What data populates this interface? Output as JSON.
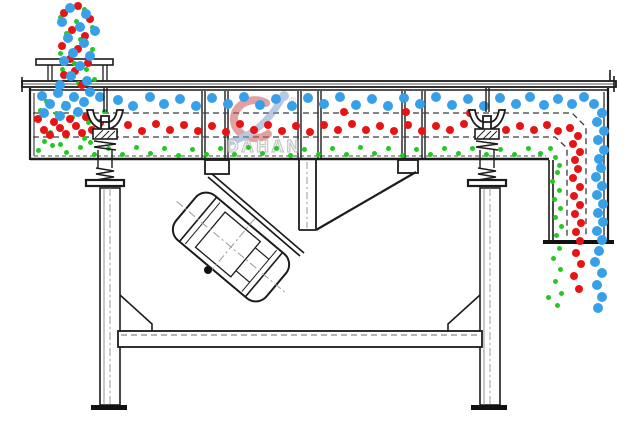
{
  "diagram": {
    "subject": "linear vibrating screen side-section schematic",
    "line_color": "#1c1c1c",
    "centerline_color": "#999999",
    "deck_dash_color": "#3c3c3c",
    "background": "#ffffff"
  },
  "watermark": {
    "text": "DAHAN",
    "reg_mark": "®",
    "letter_color": "#9a9a9a",
    "swoosh_blue": "#7d9cc8",
    "swoosh_red": "#cc5555"
  },
  "particles": {
    "blue": {
      "color": "#38a0e8",
      "diameter": 10,
      "dots": [
        [
          70,
          8
        ],
        [
          86,
          14
        ],
        [
          62,
          22
        ],
        [
          80,
          27
        ],
        [
          95,
          31
        ],
        [
          68,
          38
        ],
        [
          84,
          43
        ],
        [
          73,
          53
        ],
        [
          90,
          56
        ],
        [
          64,
          61
        ],
        [
          80,
          66
        ],
        [
          71,
          76
        ],
        [
          87,
          81
        ],
        [
          60,
          85
        ],
        [
          42,
          96
        ],
        [
          58,
          93
        ],
        [
          74,
          97
        ],
        [
          90,
          92
        ],
        [
          50,
          104
        ],
        [
          66,
          106
        ],
        [
          84,
          102
        ],
        [
          100,
          97
        ],
        [
          44,
          113
        ],
        [
          60,
          116
        ],
        [
          78,
          112
        ],
        [
          118,
          100
        ],
        [
          133,
          106
        ],
        [
          150,
          97
        ],
        [
          164,
          104
        ],
        [
          180,
          99
        ],
        [
          196,
          106
        ],
        [
          212,
          98
        ],
        [
          228,
          104
        ],
        [
          244,
          97
        ],
        [
          260,
          105
        ],
        [
          276,
          99
        ],
        [
          292,
          106
        ],
        [
          308,
          98
        ],
        [
          324,
          104
        ],
        [
          340,
          97
        ],
        [
          356,
          105
        ],
        [
          372,
          99
        ],
        [
          388,
          106
        ],
        [
          404,
          98
        ],
        [
          420,
          104
        ],
        [
          436,
          97
        ],
        [
          452,
          105
        ],
        [
          468,
          99
        ],
        [
          484,
          106
        ],
        [
          500,
          98
        ],
        [
          516,
          104
        ],
        [
          530,
          97
        ],
        [
          544,
          105
        ],
        [
          558,
          99
        ],
        [
          572,
          104
        ],
        [
          584,
          97
        ],
        [
          594,
          104
        ],
        [
          602,
          113
        ],
        [
          597,
          122
        ],
        [
          604,
          131
        ],
        [
          598,
          140
        ],
        [
          604,
          150
        ],
        [
          599,
          159
        ],
        [
          601,
          168
        ],
        [
          596,
          177
        ],
        [
          602,
          186
        ],
        [
          597,
          195
        ],
        [
          603,
          204
        ],
        [
          598,
          213
        ],
        [
          603,
          222
        ],
        [
          597,
          231
        ],
        [
          602,
          240
        ],
        [
          599,
          251
        ],
        [
          595,
          262
        ],
        [
          602,
          273
        ],
        [
          597,
          285
        ],
        [
          602,
          297
        ],
        [
          598,
          308
        ]
      ]
    },
    "red": {
      "color": "#e81414",
      "diameter": 8,
      "dots": [
        [
          78,
          6
        ],
        [
          64,
          13
        ],
        [
          90,
          19
        ],
        [
          72,
          30
        ],
        [
          85,
          36
        ],
        [
          62,
          46
        ],
        [
          78,
          49
        ],
        [
          70,
          59
        ],
        [
          88,
          63
        ],
        [
          75,
          71
        ],
        [
          64,
          75
        ],
        [
          82,
          85
        ],
        [
          38,
          119
        ],
        [
          54,
          122
        ],
        [
          70,
          119
        ],
        [
          86,
          117
        ],
        [
          100,
          123
        ],
        [
          44,
          130
        ],
        [
          60,
          128
        ],
        [
          76,
          126
        ],
        [
          92,
          130
        ],
        [
          50,
          135
        ],
        [
          66,
          134
        ],
        [
          82,
          133
        ],
        [
          114,
          132
        ],
        [
          128,
          125
        ],
        [
          142,
          131
        ],
        [
          156,
          124
        ],
        [
          170,
          130
        ],
        [
          184,
          125
        ],
        [
          198,
          131
        ],
        [
          212,
          126
        ],
        [
          226,
          132
        ],
        [
          240,
          124
        ],
        [
          254,
          130
        ],
        [
          268,
          125
        ],
        [
          282,
          131
        ],
        [
          296,
          126
        ],
        [
          310,
          132
        ],
        [
          324,
          125
        ],
        [
          338,
          130
        ],
        [
          352,
          124
        ],
        [
          366,
          130
        ],
        [
          380,
          126
        ],
        [
          394,
          131
        ],
        [
          408,
          125
        ],
        [
          422,
          131
        ],
        [
          436,
          126
        ],
        [
          450,
          130
        ],
        [
          464,
          124
        ],
        [
          506,
          130
        ],
        [
          520,
          126
        ],
        [
          534,
          130
        ],
        [
          547,
          125
        ],
        [
          558,
          131
        ],
        [
          344,
          112
        ],
        [
          406,
          112
        ],
        [
          470,
          113
        ],
        [
          570,
          128
        ],
        [
          578,
          136
        ],
        [
          573,
          144
        ],
        [
          580,
          152
        ],
        [
          575,
          160
        ],
        [
          578,
          169
        ],
        [
          573,
          178
        ],
        [
          580,
          187
        ],
        [
          574,
          196
        ],
        [
          580,
          205
        ],
        [
          575,
          214
        ],
        [
          581,
          223
        ],
        [
          576,
          232
        ],
        [
          580,
          241
        ],
        [
          576,
          253
        ],
        [
          581,
          264
        ],
        [
          574,
          276
        ],
        [
          579,
          289
        ]
      ]
    },
    "green": {
      "color": "#22c922",
      "diameter": 5,
      "dots": [
        [
          84,
          9
        ],
        [
          60,
          17
        ],
        [
          76,
          21
        ],
        [
          92,
          27
        ],
        [
          66,
          33
        ],
        [
          80,
          39
        ],
        [
          60,
          53
        ],
        [
          92,
          49
        ],
        [
          74,
          63
        ],
        [
          86,
          69
        ],
        [
          62,
          69
        ],
        [
          78,
          83
        ],
        [
          94,
          79
        ],
        [
          58,
          88
        ],
        [
          46,
          101
        ],
        [
          64,
          103
        ],
        [
          40,
          110
        ],
        [
          56,
          113
        ],
        [
          72,
          117
        ],
        [
          88,
          122
        ],
        [
          104,
          111
        ],
        [
          50,
          132
        ],
        [
          66,
          136
        ],
        [
          84,
          138
        ],
        [
          44,
          141
        ],
        [
          60,
          144
        ],
        [
          90,
          142
        ],
        [
          38,
          150
        ],
        [
          52,
          145
        ],
        [
          66,
          152
        ],
        [
          80,
          147
        ],
        [
          94,
          154
        ],
        [
          108,
          148
        ],
        [
          122,
          154
        ],
        [
          136,
          147
        ],
        [
          150,
          153
        ],
        [
          164,
          148
        ],
        [
          178,
          155
        ],
        [
          192,
          149
        ],
        [
          206,
          154
        ],
        [
          220,
          148
        ],
        [
          234,
          154
        ],
        [
          248,
          147
        ],
        [
          262,
          153
        ],
        [
          276,
          148
        ],
        [
          290,
          155
        ],
        [
          304,
          149
        ],
        [
          318,
          154
        ],
        [
          332,
          148
        ],
        [
          346,
          154
        ],
        [
          360,
          147
        ],
        [
          374,
          153
        ],
        [
          388,
          148
        ],
        [
          402,
          155
        ],
        [
          416,
          149
        ],
        [
          430,
          154
        ],
        [
          444,
          148
        ],
        [
          458,
          153
        ],
        [
          472,
          148
        ],
        [
          486,
          154
        ],
        [
          500,
          149
        ],
        [
          514,
          154
        ],
        [
          528,
          148
        ],
        [
          540,
          153
        ],
        [
          550,
          148
        ],
        [
          555,
          157
        ],
        [
          559,
          165
        ],
        [
          557,
          172
        ],
        [
          552,
          181
        ],
        [
          559,
          190
        ],
        [
          554,
          199
        ],
        [
          560,
          208
        ],
        [
          555,
          217
        ],
        [
          561,
          226
        ],
        [
          556,
          235
        ],
        [
          559,
          248
        ],
        [
          553,
          258
        ],
        [
          560,
          269
        ],
        [
          555,
          281
        ],
        [
          561,
          293
        ],
        [
          557,
          305
        ],
        [
          548,
          297
        ]
      ]
    }
  }
}
